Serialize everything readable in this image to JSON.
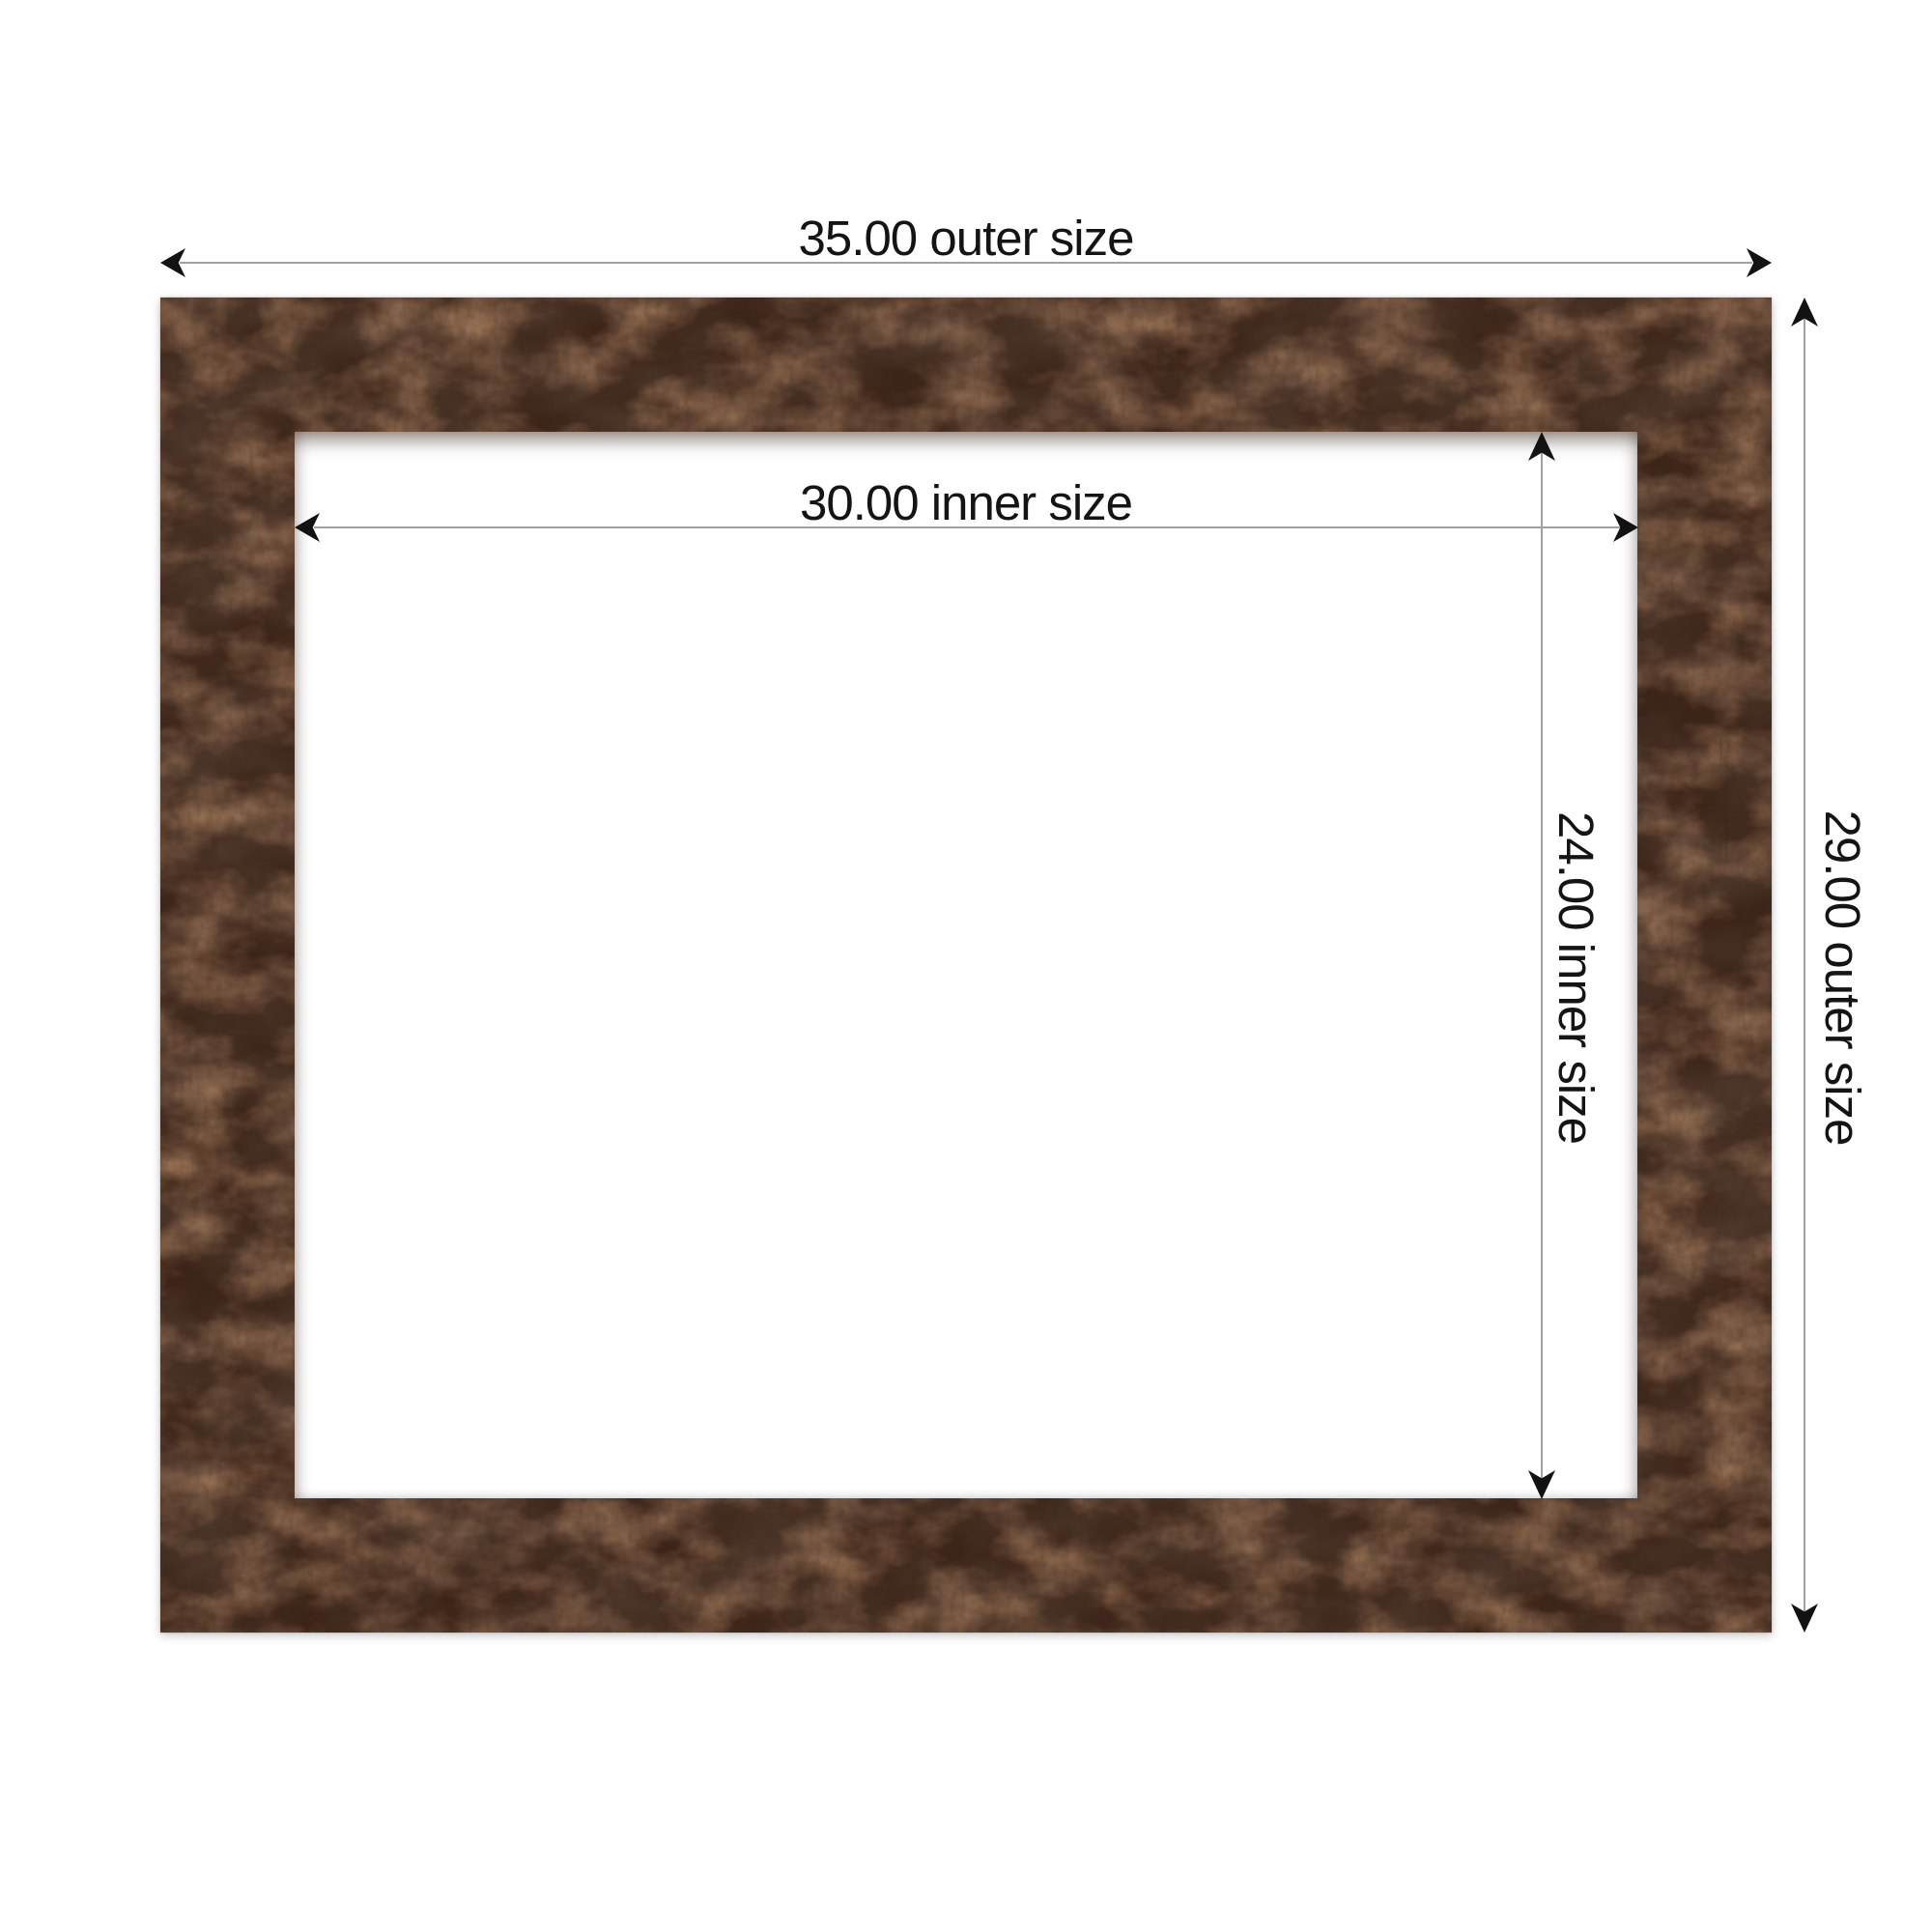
{
  "diagram": {
    "dimensions": {
      "outer_width": {
        "value": "35.00",
        "label": "35.00 outer size"
      },
      "inner_width": {
        "value": "30.00",
        "label": "30.00 inner size"
      },
      "inner_height": {
        "value": "24.00",
        "label": "24.00 inner size"
      },
      "outer_height": {
        "value": "29.00",
        "label": "29.00 outer size"
      }
    },
    "colors": {
      "background": "#ffffff",
      "frame_wood_base": "#3c2418",
      "frame_wood_dark": "#160d08",
      "frame_wood_rust": "#7a4224",
      "opening_fill": "#ffffff",
      "dimension_line": "#a0a0a0",
      "arrowhead": "#121212",
      "label_text": "#141414"
    }
  }
}
